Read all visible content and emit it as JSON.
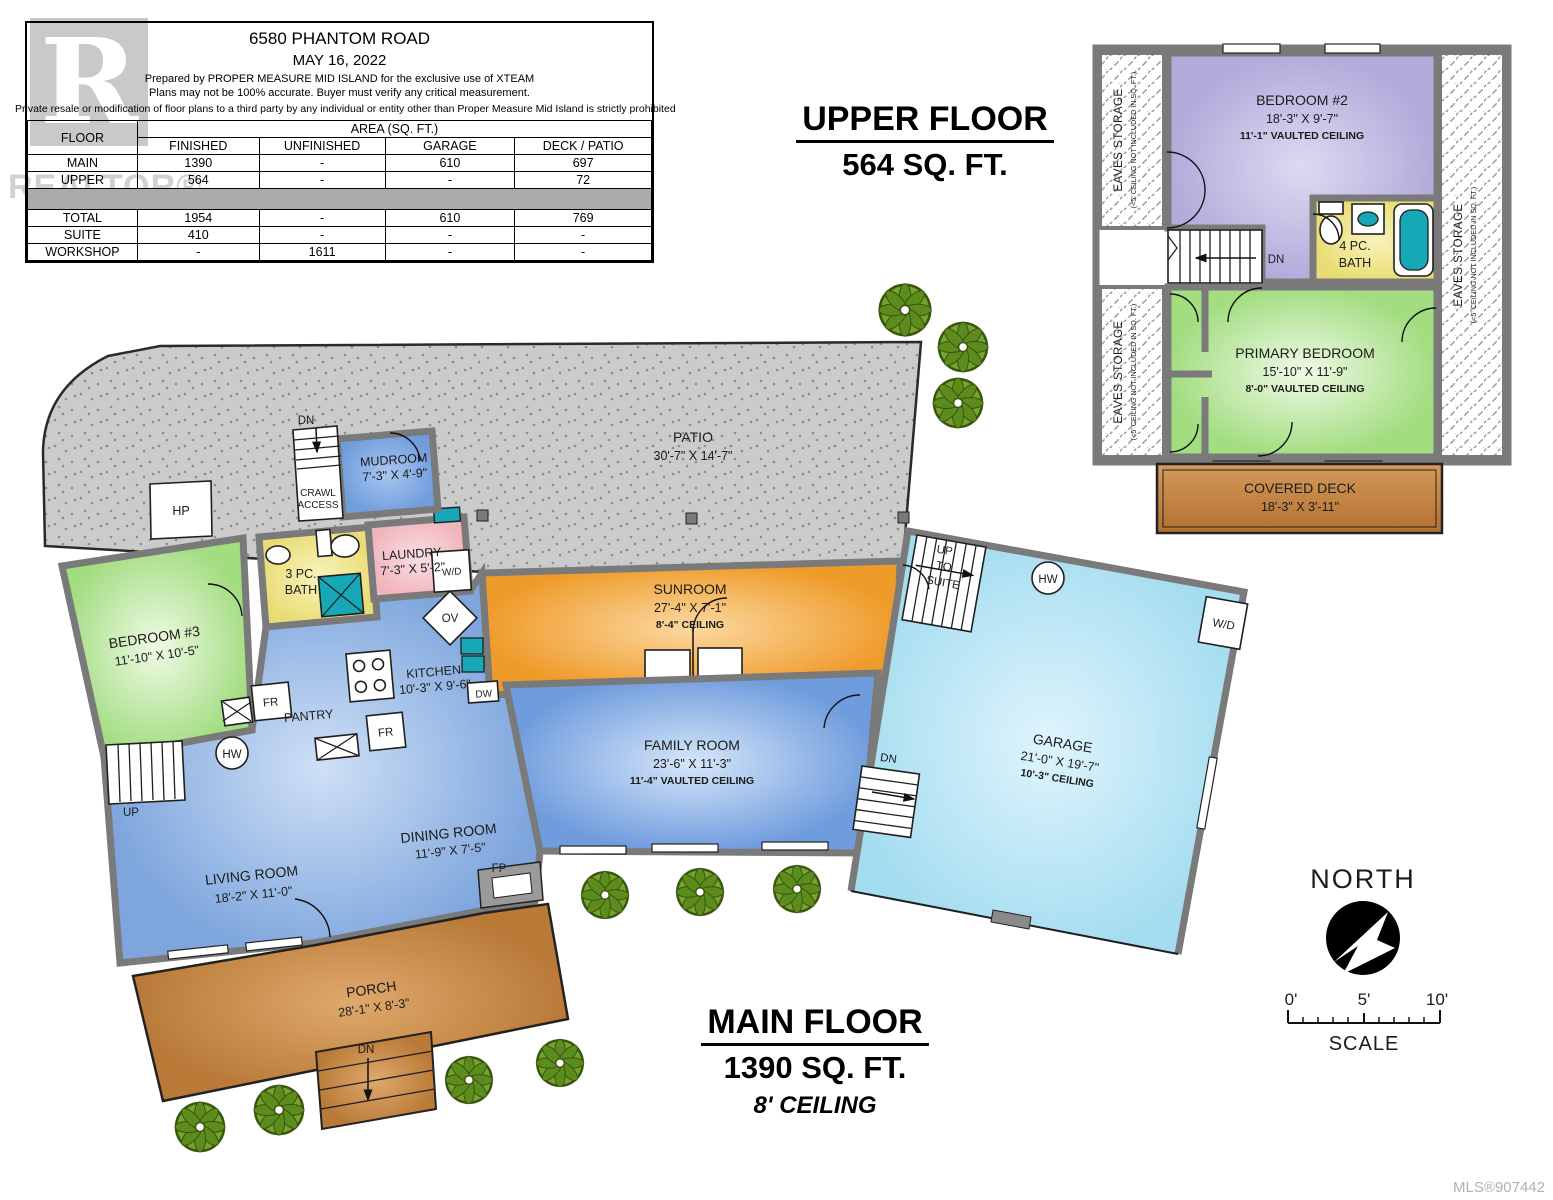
{
  "watermark": {
    "letter": "R",
    "text": "REALTOR®"
  },
  "info_table": {
    "address": "6580 PHANTOM ROAD",
    "date": "MAY 16, 2022",
    "prepared_line": "Prepared by PROPER MEASURE MID ISLAND for the exclusive use of XTEAM",
    "accuracy_line": "Plans may not be 100% accurate.  Buyer must verify any critical measurement.",
    "private_line": "Private resale  or modification of floor plans to a third party by any individual or entity other than Proper Measure Mid Island is strictly prohibited",
    "floor_header": "FLOOR",
    "area_header": "AREA (SQ. FT.)",
    "columns": [
      "FINISHED",
      "UNFINISHED",
      "GARAGE",
      "DECK / PATIO"
    ],
    "rows": [
      {
        "label": "MAIN",
        "finished": "1390",
        "unfinished": "-",
        "garage": "610",
        "deck_patio": "697"
      },
      {
        "label": "UPPER",
        "finished": "564",
        "unfinished": "-",
        "garage": "-",
        "deck_patio": "72"
      },
      {
        "label": "TOTAL",
        "finished": "1954",
        "unfinished": "-",
        "garage": "610",
        "deck_patio": "769"
      },
      {
        "label": "SUITE",
        "finished": "410",
        "unfinished": "-",
        "garage": "-",
        "deck_patio": "-"
      },
      {
        "label": "WORKSHOP",
        "finished": "-",
        "unfinished": "1611",
        "garage": "-",
        "deck_patio": "-"
      }
    ]
  },
  "upper_title": {
    "line1": "UPPER FLOOR",
    "line2": "564 SQ. FT."
  },
  "main_title": {
    "line1": "MAIN FLOOR",
    "line2": "1390 SQ. FT.",
    "line3": "8' CEILING"
  },
  "upper_floor": {
    "bedroom2": {
      "name": "BEDROOM #2",
      "dims": "18'-3\" X 9'-7\"",
      "ceiling": "11'-1\" VAULTED CEILING"
    },
    "bath": {
      "l1": "4 PC.",
      "l2": "BATH"
    },
    "primary": {
      "name": "PRIMARY BEDROOM",
      "dims": "15'-10\" X 11'-9\"",
      "ceiling": "8'-0\" VAULTED CEILING"
    },
    "deck": {
      "name": "COVERED DECK",
      "dims": "18'-3\" X 3'-11\""
    },
    "eaves": "EAVES STORAGE",
    "eaves_note": "(<5' CEILING NOT INCLUDED IN SQ. FT.)",
    "dn": "DN"
  },
  "plan_labels": {
    "patio": {
      "name": "PATIO",
      "dims": "30'-7\" X 14'-7\""
    },
    "sunroom": {
      "name": "SUNROOM",
      "dims": "27'-4\" X 7'-1\"",
      "ceiling": "8'-4\" CEILING"
    },
    "mudroom": {
      "name": "MUDROOM",
      "dims": "7'-3\" X 4'-9\""
    },
    "laundry": {
      "name": "LAUNDRY",
      "dims": "7'-3\" X 5'-2\""
    },
    "bath3": {
      "l1": "3 PC.",
      "l2": "BATH"
    },
    "bedroom3": {
      "name": "BEDROOM #3",
      "dims": "11'-10\" X 10'-5\""
    },
    "kitchen": {
      "name": "KITCHEN",
      "dims": "10'-3\" X 9'-6\""
    },
    "pantry": "PANTRY",
    "dining": {
      "name": "DINING ROOM",
      "dims": "11'-9\" X 7'-5\""
    },
    "living": {
      "name": "LIVING ROOM",
      "dims": "18'-2\" X 11'-0\""
    },
    "family": {
      "name": "FAMILY ROOM",
      "dims": "23'-6\" X 11'-3\"",
      "ceiling": "11'-4\" VAULTED CEILING"
    },
    "porch": {
      "name": "PORCH",
      "dims": "28'-1\" X 8'-3\""
    },
    "garage": {
      "name": "GARAGE",
      "dims": "21'-0\" X 19'-7\"",
      "ceiling": "10'-3\" CEILING"
    },
    "crawl": {
      "l1": "CRAWL",
      "l2": "ACCESS"
    },
    "suite_stairs": {
      "l1": "UP",
      "l2": "TO",
      "l3": "SUITE"
    },
    "abbr": {
      "dn": "DN",
      "up": "UP",
      "hp": "HP",
      "hw": "HW",
      "fr": "FR",
      "ov": "OV",
      "dw": "DW",
      "wd": "W/D",
      "fp": "FP"
    }
  },
  "compass": {
    "label": "NORTH"
  },
  "scale_bar": {
    "t0": "0'",
    "t5": "5'",
    "t10": "10'",
    "label": "SCALE"
  },
  "mls": "MLS®907442",
  "colors": {
    "wall": "#7a7a7a",
    "patio": "#cbcbcb",
    "teal": "#17a8b8",
    "shrub": "#76a32c",
    "deck_brown": "#c08040"
  }
}
